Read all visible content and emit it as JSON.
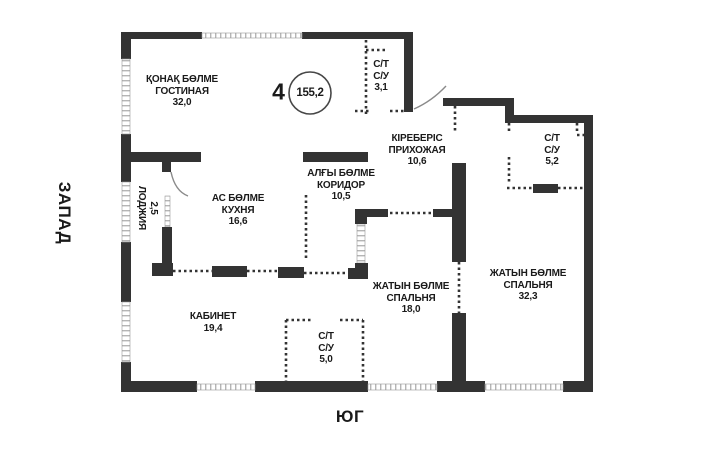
{
  "compass": {
    "west": "ЗАПАД",
    "south": "ЮГ"
  },
  "apartment": {
    "rooms_count": "4",
    "total_area": "155,2"
  },
  "rooms": {
    "living": {
      "name_kk": "ҚОНАҚ БӨЛМЕ",
      "name_ru": "ГОСТИНАЯ",
      "area": "32,0"
    },
    "bath_top": {
      "line1": "С/Т",
      "line2": "С/У",
      "area": "3,1"
    },
    "hallway": {
      "name_kk": "КІРЕБЕРІС",
      "name_ru": "ПРИХОЖАЯ",
      "area": "10,6"
    },
    "bath_right": {
      "line1": "С/Т",
      "line2": "С/У",
      "area": "5,2"
    },
    "loggia": {
      "name_ru": "ЛОДЖИЯ",
      "area": "2,5"
    },
    "kitchen": {
      "name_kk": "АС БӨЛМЕ",
      "name_ru": "КУХНЯ",
      "area": "16,6"
    },
    "corridor": {
      "name_kk": "АЛҒЫ БӨЛМЕ",
      "name_ru": "КОРИДОР",
      "area": "10,5"
    },
    "bedroom_mid": {
      "name_kk": "ЖАТЫН БӨЛМЕ",
      "name_ru": "СПАЛЬНЯ",
      "area": "18,0"
    },
    "bedroom_right": {
      "name_kk": "ЖАТЫН БӨЛМЕ",
      "name_ru": "СПАЛЬНЯ",
      "area": "32,3"
    },
    "office": {
      "name_ru": "КАБИНЕТ",
      "area": "19,4"
    },
    "bath_bottom": {
      "line1": "С/Т",
      "line2": "С/У",
      "area": "5,0"
    }
  },
  "colors": {
    "wall": "#333333",
    "text": "#1a1a1a",
    "window": "#aaaaaa",
    "background": "#ffffff"
  }
}
